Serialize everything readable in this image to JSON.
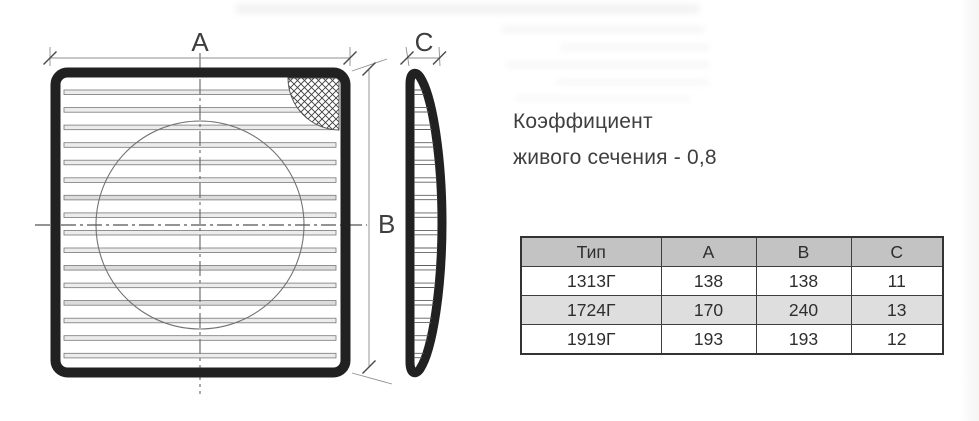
{
  "document": {
    "note": {
      "line1": "Коэффициент",
      "line2": "живого сечения - 0,8"
    },
    "drawing": {
      "dim_a_label": "A",
      "dim_b_label": "B",
      "dim_c_label": "C"
    },
    "table": {
      "columns": [
        "Тип",
        "A",
        "B",
        "C"
      ],
      "rows": [
        [
          "1313Г",
          "138",
          "138",
          "11"
        ],
        [
          "1724Г",
          "170",
          "240",
          "13"
        ],
        [
          "1919Г",
          "193",
          "193",
          "12"
        ]
      ]
    },
    "colors": {
      "drawing_line": "#212121",
      "table_border": "#3e3e3e",
      "table_header_bg": "#c3c3c3",
      "table_stripe_bg": "#dedede",
      "text": "#3f3f3f"
    }
  }
}
